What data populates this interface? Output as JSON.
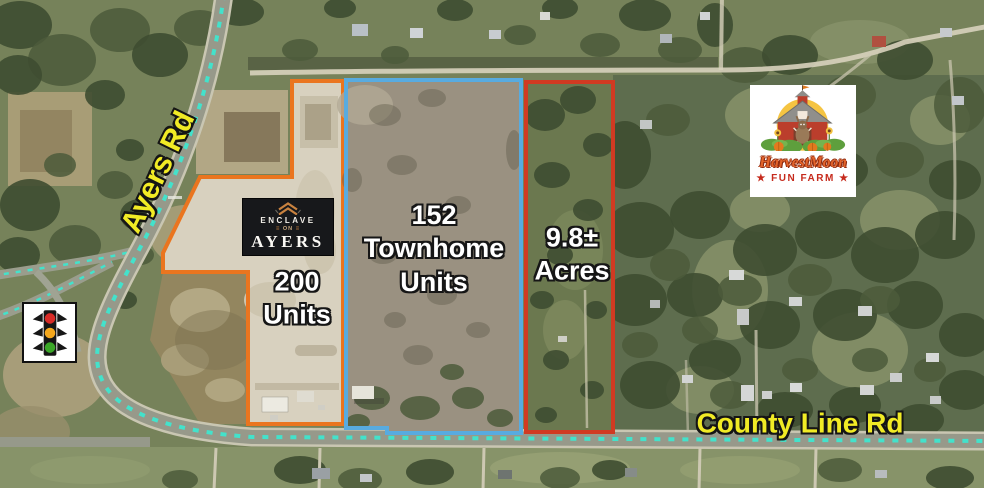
{
  "map": {
    "road_labels": {
      "ayers": "Ayers Rd",
      "county_line": "County Line Rd"
    },
    "road_label_color": "#F1EB25",
    "road_dash_color": "#43E2CB",
    "parcel_label_color": "#FFFFFF",
    "parcels": [
      {
        "key": "orange",
        "outline_color": "#EA751F",
        "label_lines": [
          "200",
          "Units"
        ]
      },
      {
        "key": "blue",
        "outline_color": "#58ABE0",
        "label_lines": [
          "152",
          "Townhome",
          "Units"
        ]
      },
      {
        "key": "red",
        "outline_color": "#D13A22",
        "label_lines": [
          "9.8±",
          "Acres"
        ]
      }
    ],
    "logos": {
      "enclave": {
        "brand_top": "ENCLAVE",
        "brand_mid": "ON",
        "brand_bottom": "AYERS",
        "divider_glyph": "≡",
        "accent_color": "#C9823F",
        "background": "#17181B"
      },
      "harvest_moon": {
        "title": "HarvestMoon",
        "subtitle": "★ FUN FARM ★",
        "title_color": "#E2632A",
        "subtitle_color": "#C62A1C"
      }
    },
    "icons": {
      "traffic_signal": {
        "red": "#D92B27",
        "amber": "#F4A71D",
        "green": "#3BA828"
      }
    }
  }
}
